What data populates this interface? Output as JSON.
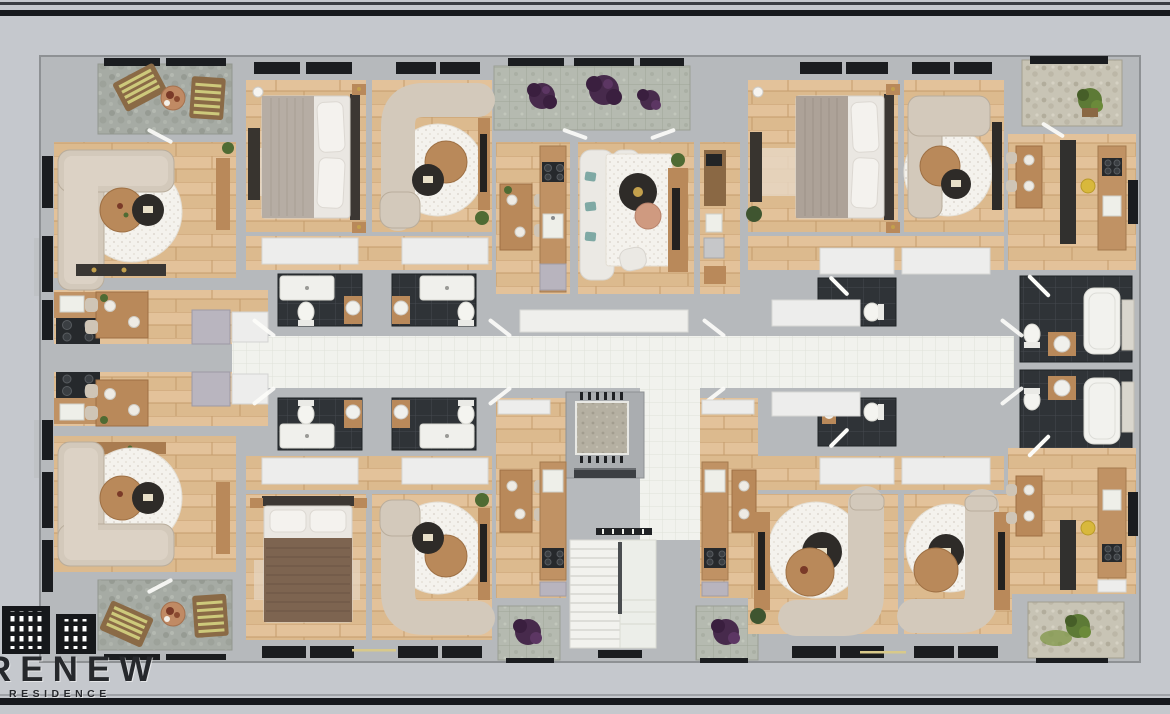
{
  "scene": {
    "kind": "3d-floor-plan-top-down-render",
    "subject": "residential apartment floor with central corridor, elevator and stair core",
    "apartments_visible": 8,
    "frame": {
      "top_bar": true,
      "bottom_bar": true
    }
  },
  "logo": {
    "brand": "RENEW",
    "sub": "RESIDENCE",
    "icon": "two-buildings-icon"
  },
  "palette": {
    "background": "#c5c8cd",
    "frame_bar": "#17191d",
    "frame_bar_soft": "#3a3d42",
    "wall": "#b6b9bc",
    "wall_edge": "#8e9194",
    "wood_floor": "#dcba8e",
    "wood_grain": "#c49c6c",
    "corridor_tile": "#f1f2ed",
    "corridor_tile_line": "#dfe1d9",
    "bathroom_tile": "#2f3337",
    "bathroom_tile_line": "#454a4f",
    "stone_gray": "#a6aba4",
    "stone_green_tile": "#b5bab0",
    "stone_beige": "#c8c4b5",
    "elevator_floor": "#b5b0a2",
    "rug_white": "#f4f2ed",
    "sofa_beige": "#d3c9bb",
    "sofa_white": "#ebe9e4",
    "teal_pillow": "#7fa9a4",
    "wood_furniture": "#b9895a",
    "dark_furniture": "#2e2b28",
    "bed_blanket_gray": "#b6ada4",
    "bed_blanket_brown": "#7d6450",
    "lounger_wood": "#8a6a46",
    "lounger_stripe": "#cdc97b",
    "plant_purple": "#472a4c",
    "plant_green": "#5d7a36",
    "accent_gold": "#c3a04c",
    "white_goods": "#ededec",
    "window_glass": "#1b1d20"
  },
  "rooms": [
    {
      "id": "balcony-top-left",
      "type": "balcony",
      "features": [
        "2 striped loungers",
        "round table"
      ]
    },
    {
      "id": "living-top-left",
      "type": "living-room",
      "features": [
        "L sofa",
        "round rug",
        "coffee tables"
      ]
    },
    {
      "id": "kitchen-left-top",
      "type": "kitchen-dining",
      "features": [
        "cooktop",
        "dining table",
        "fridge"
      ]
    },
    {
      "id": "kitchen-left-bottom",
      "type": "kitchen-dining",
      "features": [
        "cooktop",
        "dining table",
        "fridge"
      ]
    },
    {
      "id": "living-bottom-left",
      "type": "living-room",
      "features": [
        "L sofa",
        "round rug"
      ]
    },
    {
      "id": "balcony-bottom-left",
      "type": "balcony",
      "features": [
        "2 striped loungers",
        "round table"
      ]
    },
    {
      "id": "bedroom-top-a",
      "type": "bedroom",
      "features": [
        "double bed",
        "nightstands"
      ]
    },
    {
      "id": "living-top-a",
      "type": "living-room",
      "features": [
        "curved sofa",
        "round rug"
      ]
    },
    {
      "id": "bathroom-top-1",
      "type": "bathroom",
      "features": [
        "shower",
        "toilet",
        "vanity"
      ]
    },
    {
      "id": "bathroom-top-2",
      "type": "bathroom",
      "features": [
        "shower",
        "toilet",
        "vanity"
      ]
    },
    {
      "id": "balcony-top-center",
      "type": "balcony",
      "features": [
        "purple plants"
      ]
    },
    {
      "id": "kitchen-top-center",
      "type": "kitchen-dining",
      "features": [
        "counter",
        "stove",
        "sink"
      ]
    },
    {
      "id": "living-top-center",
      "type": "living-room",
      "features": [
        "white sofa",
        "teal pillows",
        "tv-console"
      ]
    },
    {
      "id": "bedroom-top-right",
      "type": "bedroom",
      "features": [
        "double bed"
      ]
    },
    {
      "id": "living-top-right",
      "type": "living-room",
      "features": [
        "curved sofa"
      ]
    },
    {
      "id": "kitchen-top-right",
      "type": "kitchen",
      "features": [
        "tall cabinets",
        "stove",
        "sink",
        "stool"
      ]
    },
    {
      "id": "balcony-top-right",
      "type": "balcony",
      "features": [
        "green plant"
      ]
    },
    {
      "id": "corridor",
      "type": "corridor",
      "features": [
        "white tile"
      ]
    },
    {
      "id": "elevator",
      "type": "elevator-shaft"
    },
    {
      "id": "staircase",
      "type": "stairwell"
    },
    {
      "id": "bathroom-right-top",
      "type": "bathroom",
      "features": [
        "bathtub",
        "toilet",
        "vanity"
      ]
    },
    {
      "id": "bathroom-right-bottom",
      "type": "bathroom",
      "features": [
        "bathtub",
        "toilet",
        "vanity"
      ]
    },
    {
      "id": "bathroom-mid-top",
      "type": "bathroom",
      "features": [
        "toilet",
        "vanity"
      ]
    },
    {
      "id": "bathroom-mid-bottom",
      "type": "bathroom",
      "features": [
        "toilet",
        "vanity"
      ]
    },
    {
      "id": "bathroom-bottom-1",
      "type": "bathroom"
    },
    {
      "id": "bathroom-bottom-2",
      "type": "bathroom"
    },
    {
      "id": "bedroom-bottom-left",
      "type": "bedroom",
      "features": [
        "brown blanket bed"
      ]
    },
    {
      "id": "living-bottom-a",
      "type": "living-room",
      "features": [
        "curved sofa"
      ]
    },
    {
      "id": "kitchen-bottom-center-left",
      "type": "kitchen",
      "features": [
        "stove",
        "sink",
        "dining table"
      ]
    },
    {
      "id": "kitchen-bottom-center-right",
      "type": "kitchen",
      "features": [
        "stove",
        "sink",
        "dining table"
      ]
    },
    {
      "id": "balcony-bottom-center-left",
      "type": "balcony",
      "features": [
        "purple plant"
      ]
    },
    {
      "id": "balcony-bottom-center-right",
      "type": "balcony",
      "features": [
        "purple plant"
      ]
    },
    {
      "id": "living-bottom-right-1",
      "type": "living-room",
      "features": [
        "curved sofa",
        "tv-console"
      ]
    },
    {
      "id": "living-bottom-right-2",
      "type": "living-room",
      "features": [
        "curved sofa",
        "tv-console"
      ]
    },
    {
      "id": "kitchen-bottom-right",
      "type": "kitchen",
      "features": [
        "tall cabinets",
        "stove",
        "sink",
        "stool"
      ]
    },
    {
      "id": "balcony-bottom-right",
      "type": "balcony",
      "features": [
        "green plant"
      ]
    }
  ]
}
